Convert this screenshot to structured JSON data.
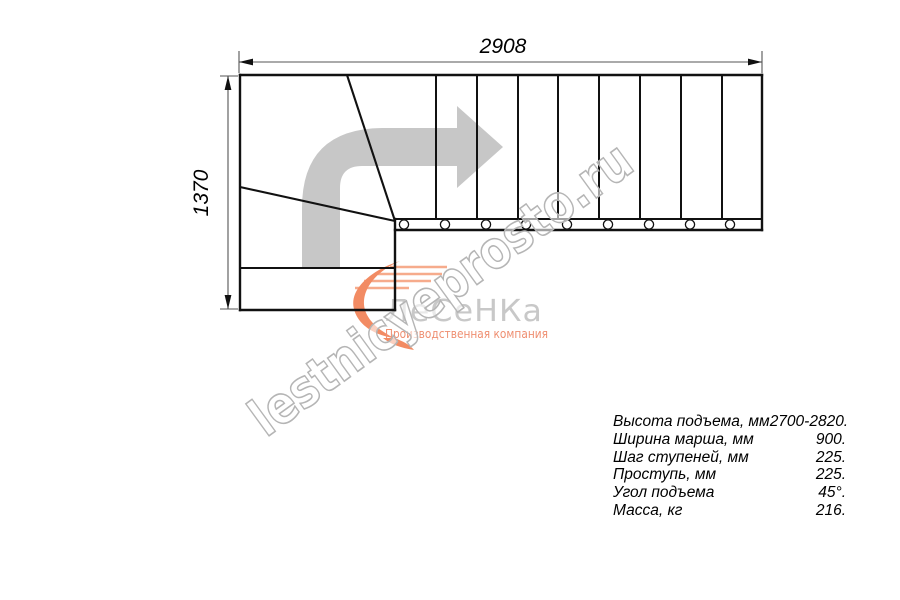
{
  "drawing": {
    "width_dim_label": "2908",
    "height_dim_label": "1370",
    "straight_treads": 9,
    "winder_lines": 2,
    "bolt_holes": 9,
    "line_color": "#111111",
    "dimension_line_color": "#555555",
    "direction_arrow_color": "#c7c7c7"
  },
  "icons": {
    "direction_arrow": "right-turn-route-arrow",
    "logo_flame": "flame-swoosh"
  },
  "watermark": {
    "text": "lestnicyeprosto.ru",
    "stroke_color": "#b5b5b5"
  },
  "logo": {
    "brand": "ЛеСеНКа",
    "tagline": "Производственная компания",
    "brand_color": "#c8c8c8",
    "accent_color": "#f28b63"
  },
  "specs": {
    "rows": [
      {
        "label": "Высота подъема, мм",
        "value": "2700-2820."
      },
      {
        "label": "Ширина марша, мм",
        "value": "900."
      },
      {
        "label": "Шаг ступеней, мм",
        "value": "225."
      },
      {
        "label": "Проступь, мм",
        "value": "225."
      },
      {
        "label": "Угол подъема",
        "value": "45°."
      },
      {
        "label": "Масса, кг",
        "value": "216."
      }
    ]
  }
}
